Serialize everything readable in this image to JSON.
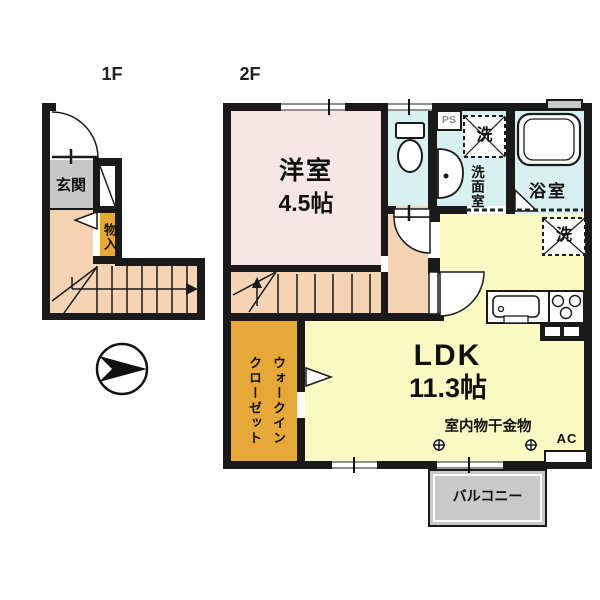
{
  "floor_labels": {
    "first": "1F",
    "second": "2F"
  },
  "rooms": {
    "entrance": "玄関",
    "storage": "物入",
    "western_room": "洋室",
    "western_room_size": "4.5帖",
    "ldk": "LDK",
    "ldk_size": "11.3帖",
    "walk_in_closet_line1": "ウォークイン",
    "walk_in_closet_line2": "クローゼット",
    "washroom": "洗面室",
    "bathroom": "浴室",
    "balcony": "バルコニー"
  },
  "symbols": {
    "pipe_space": "PS",
    "washer_washroom": "洗",
    "washer_ldk": "洗",
    "air_conditioner": "AC",
    "indoor_laundry_hardware": "室内物干金物"
  },
  "colors": {
    "wall": "#1a1a1a",
    "western_room_fill": "#f7e6e6",
    "wet_area_fill": "#d8f0ef",
    "ldk_fill": "#fafac5",
    "hall_stairs_fill": "#f4d4b4",
    "closet_fill": "#e7a83a",
    "entrance_floor_fill": "#c7c7c7",
    "balcony_fill": "#c9c9c9"
  }
}
